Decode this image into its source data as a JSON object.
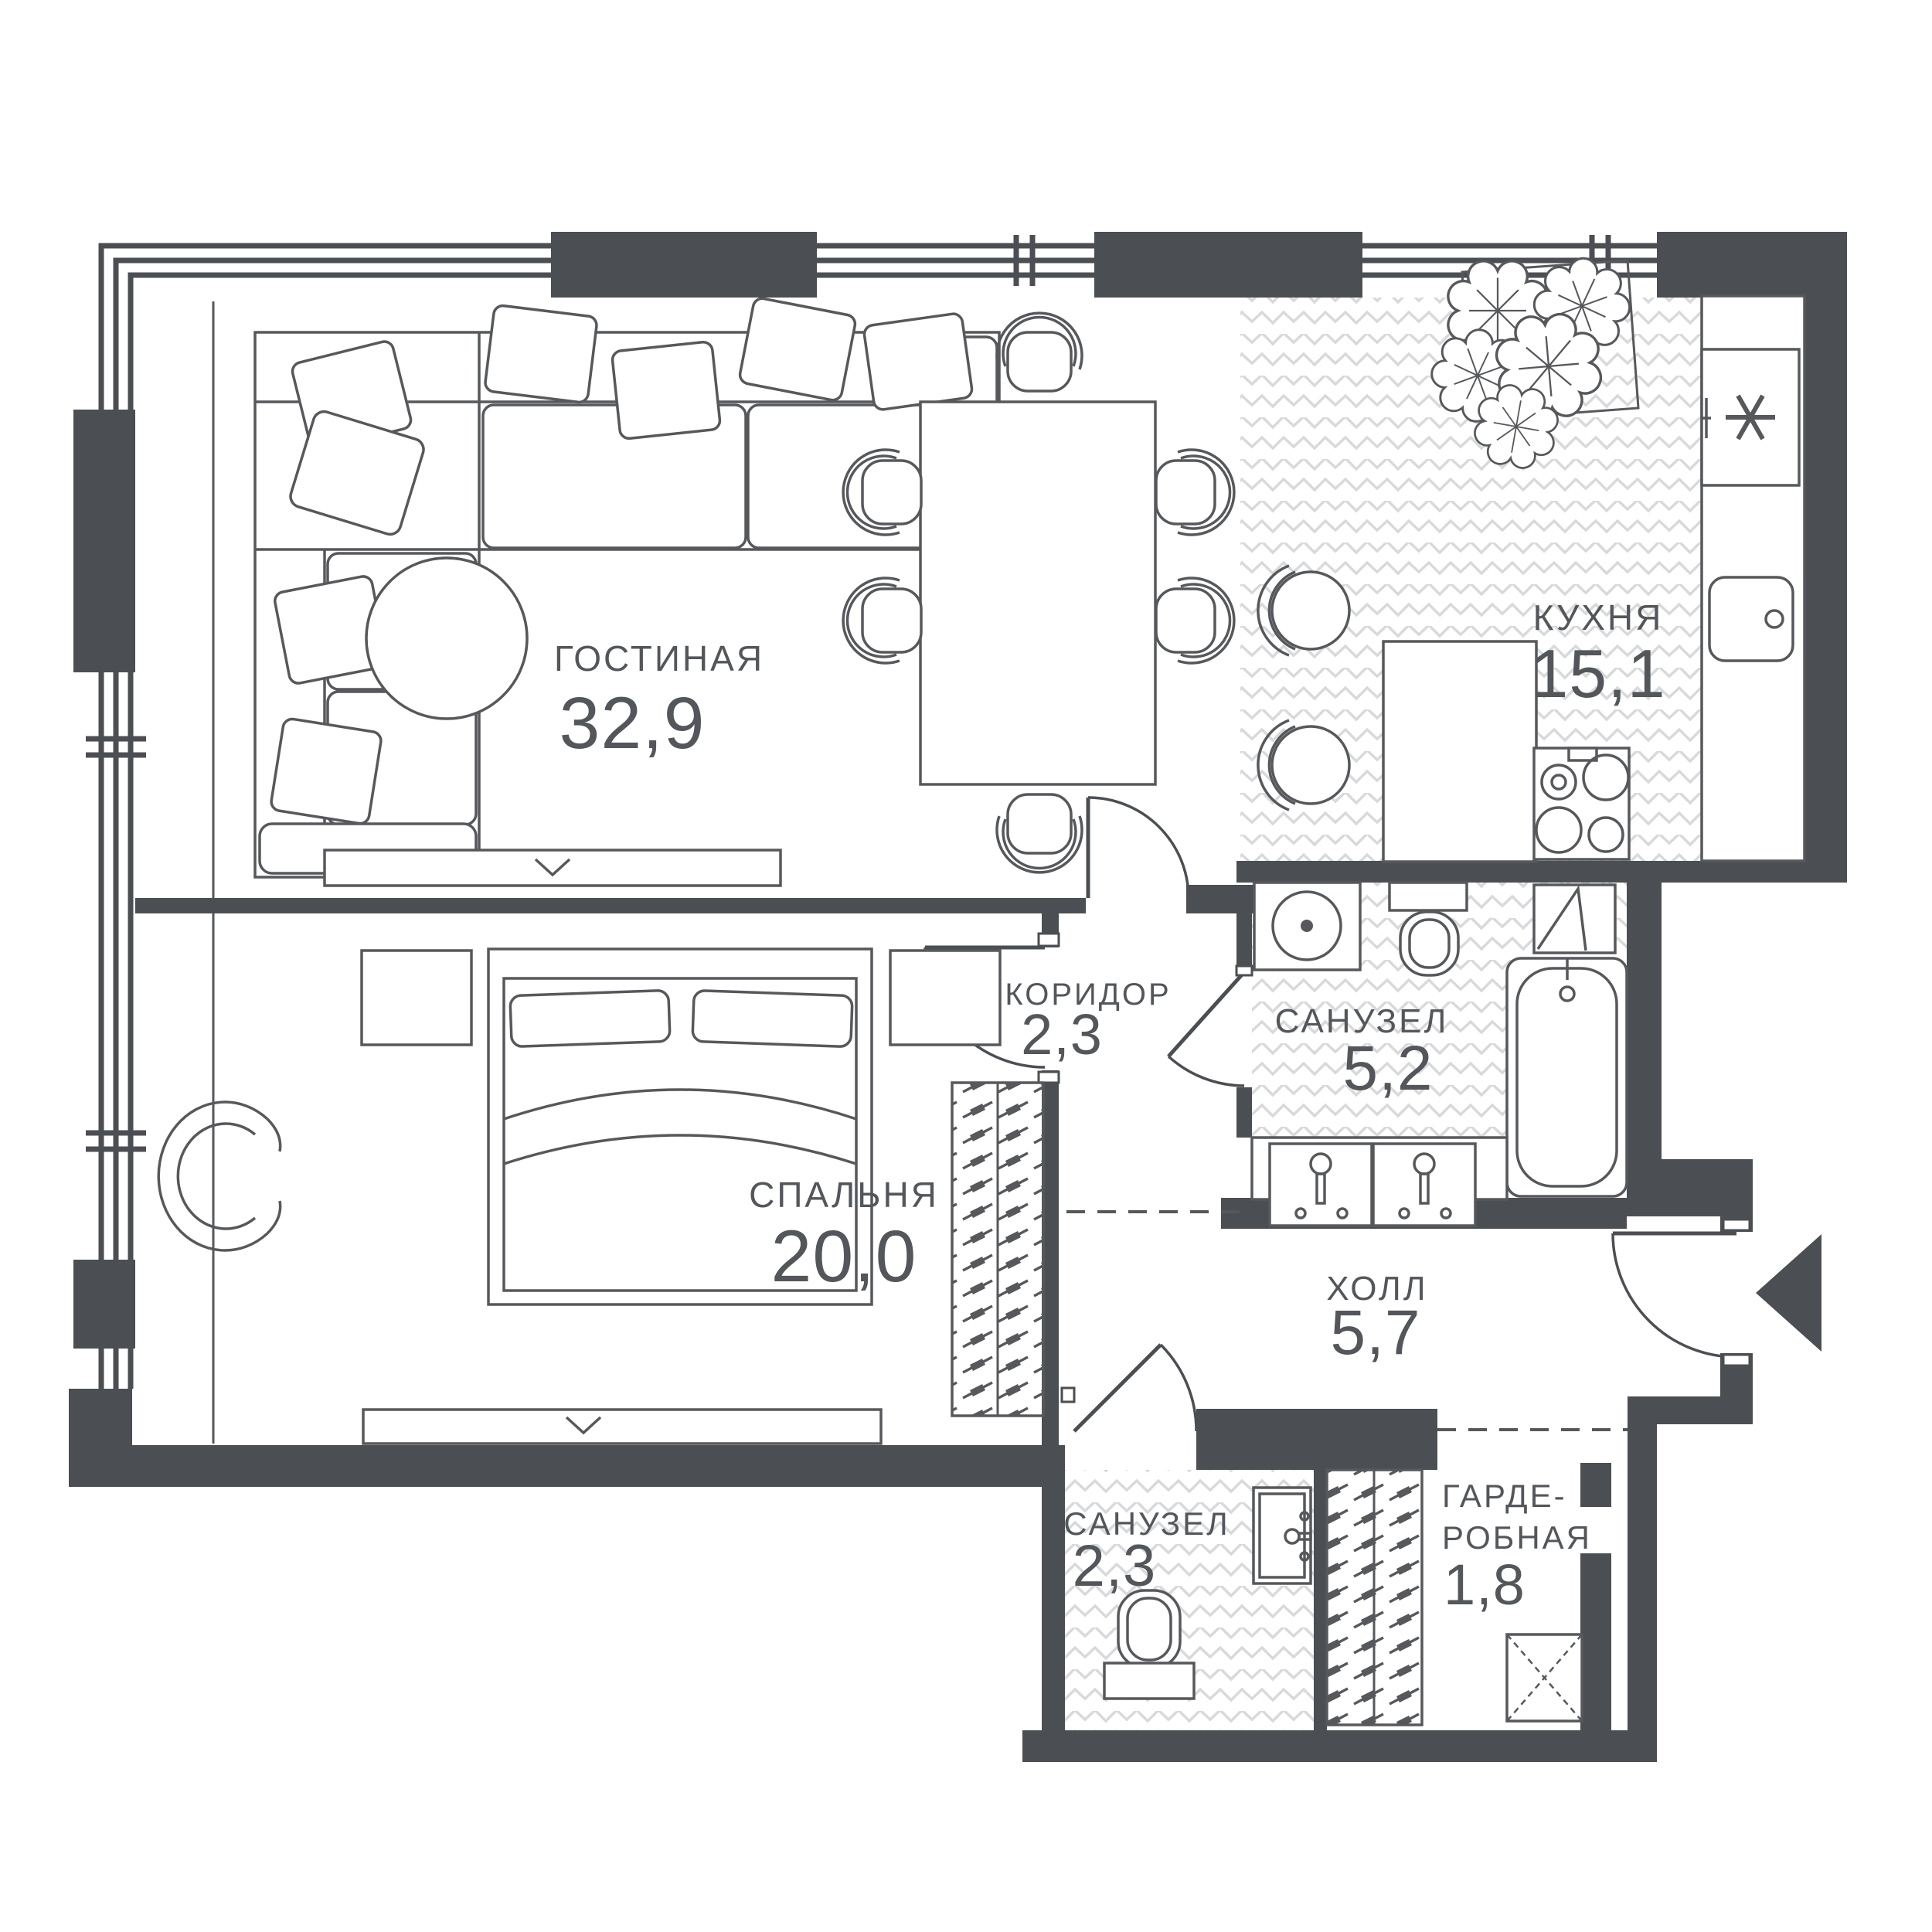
{
  "plan": {
    "type": "apartment-floor-plan",
    "units": "square meters (areas shown with decimal comma)",
    "rooms": {
      "living": {
        "name": "ГОСТИНАЯ",
        "area": "32,9"
      },
      "kitchen": {
        "name": "КУХНЯ",
        "area": "15,1"
      },
      "corridor": {
        "name": "КОРИДОР",
        "area": "2,3"
      },
      "bathroom_main": {
        "name": "САНУЗЕЛ",
        "area": "5,2"
      },
      "bedroom": {
        "name": "СПАЛЬНЯ",
        "area": "20,0"
      },
      "hall": {
        "name": "ХОЛЛ",
        "area": "5,7"
      },
      "bathroom_small": {
        "name": "САНУЗЕЛ",
        "area": "2,3"
      },
      "wardrobe": {
        "line1": "ГАРДЕ-",
        "line2": "РОБНАЯ",
        "area": "1,8"
      }
    },
    "colors": {
      "wall": "#4B4E52",
      "furniture_line": "#56585B",
      "hatch": "#D8D9DB",
      "text": "#53565A",
      "background": "#FFFFFF"
    },
    "icons": [
      "corner-sofa-icon",
      "pillow-icon",
      "coffee-table-icon",
      "tv-console-icon",
      "dining-table-icon",
      "dining-chair-icon",
      "kitchen-island-icon",
      "bar-stool-icon",
      "plant-icon",
      "fridge-icon",
      "kitchen-sink-icon",
      "stove-icon",
      "washing-machine-icon",
      "toilet-icon",
      "bathtub-icon",
      "washbasin-icon",
      "duct-icon",
      "bed-icon",
      "nightstand-icon",
      "armchair-icon",
      "wardrobe-rack-icon",
      "shelf-icon",
      "door-arc-icon",
      "entry-arrow-icon",
      "window-icon"
    ]
  }
}
